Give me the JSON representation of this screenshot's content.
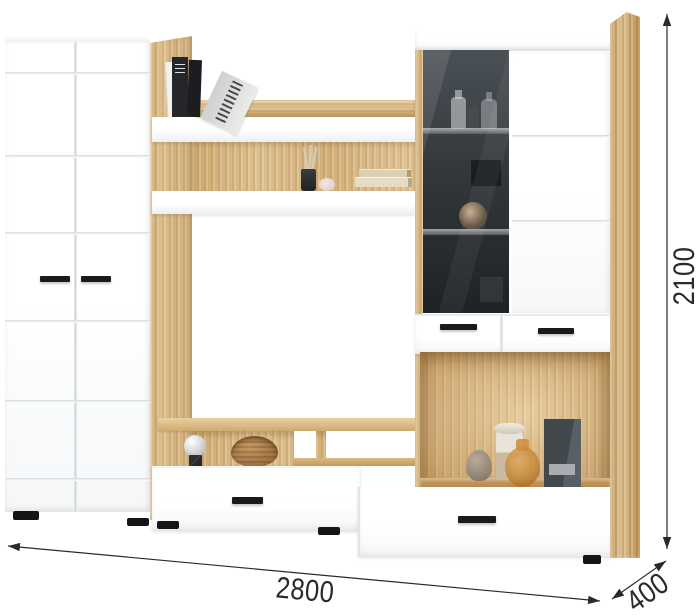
{
  "dimension_labels": {
    "width": "2800",
    "depth": "400",
    "height": "2100"
  },
  "colors": {
    "wood": "#d8b987",
    "wood-dark": "#bf9a63",
    "wood-deep": "#a97f44",
    "panel": "#ffffff",
    "groove": "#d3d8db",
    "glass-top": "#4a5156",
    "glass-mid": "#33383c",
    "glass-bottom": "#1e2225",
    "handle": "#191a1c",
    "dim": "#2a2a2a"
  },
  "decor": {
    "items": [
      "standing-books",
      "leaning-book",
      "reed-diffuser",
      "pink-trinket",
      "lying-books",
      "perfume-bottles",
      "decor-sphere",
      "sphere-lamp",
      "wooden-bowl",
      "stone-vase",
      "ceramic-vase",
      "amber-glass-vase",
      "dark-gift-box"
    ]
  }
}
